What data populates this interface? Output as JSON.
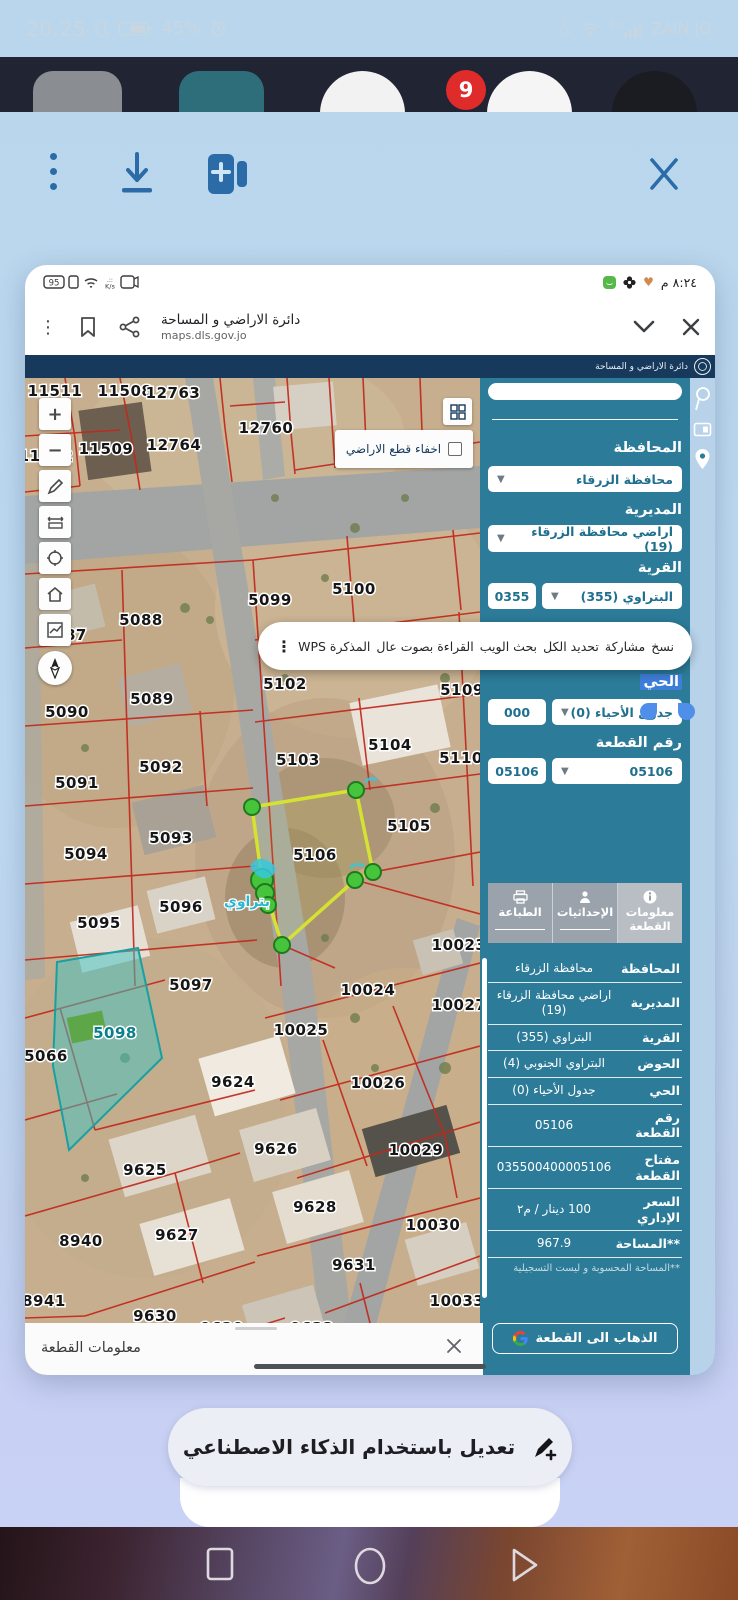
{
  "status_bar": {
    "time": "20:25",
    "battery_pct": "45%",
    "net_speed_value": "0",
    "net_speed_unit": "K/s",
    "net_gen": "4G",
    "carrier": "ZAIN JO"
  },
  "notification_badge": "9",
  "colors": {
    "panel_teal": "#2b7b99",
    "navy_header": "#16395c",
    "parcel_line_red": "#c2281c",
    "highlight_yellow": "#d6e232",
    "selected_parcel_teal": "#3ec4c4",
    "toolbar_blue": "#2b6ca8",
    "selection_blue": "#3d7ed8"
  },
  "inner_screenshot": {
    "status_bar": {
      "battery_pct": "95",
      "speed_unit": "K/s",
      "time": "٨:٢٤ م"
    },
    "browser": {
      "title": "دائرة الاراضي و المساحة",
      "url": "maps.dls.gov.jo"
    },
    "site_header": {
      "title": "دائرة الاراضي و المساحة"
    },
    "map": {
      "hide_parcels_label": "اخفاء قطع الاراضي",
      "marker_label": "بتراوي",
      "highlighted_parcel_id": "5106",
      "selected_fill_parcel_id": "5098",
      "parcel_labels": [
        {
          "id": "11511",
          "x": 30,
          "y": 18
        },
        {
          "id": "11508",
          "x": 100,
          "y": 18
        },
        {
          "id": "12763",
          "x": 148,
          "y": 20
        },
        {
          "id": "12760",
          "x": 241,
          "y": 55
        },
        {
          "id": "11509",
          "x": 81,
          "y": 76
        },
        {
          "id": "12764",
          "x": 149,
          "y": 72
        },
        {
          "id": "11512",
          "x": 21,
          "y": 83
        },
        {
          "id": "5088",
          "x": 116,
          "y": 247
        },
        {
          "id": "5087",
          "x": 40,
          "y": 262
        },
        {
          "id": "5099",
          "x": 245,
          "y": 227
        },
        {
          "id": "5100",
          "x": 329,
          "y": 216
        },
        {
          "id": "5107",
          "x": 436,
          "y": 257
        },
        {
          "id": "5102",
          "x": 260,
          "y": 311
        },
        {
          "id": "5109",
          "x": 437,
          "y": 317
        },
        {
          "id": "5090",
          "x": 42,
          "y": 339
        },
        {
          "id": "5089",
          "x": 127,
          "y": 326
        },
        {
          "id": "5092",
          "x": 136,
          "y": 394
        },
        {
          "id": "5104",
          "x": 365,
          "y": 372
        },
        {
          "id": "5103",
          "x": 273,
          "y": 387
        },
        {
          "id": "5110",
          "x": 436,
          "y": 385
        },
        {
          "id": "5091",
          "x": 52,
          "y": 410
        },
        {
          "id": "5105",
          "x": 384,
          "y": 453
        },
        {
          "id": "5094",
          "x": 61,
          "y": 481
        },
        {
          "id": "5093",
          "x": 146,
          "y": 465
        },
        {
          "id": "5106",
          "x": 290,
          "y": 482
        },
        {
          "id": "5096",
          "x": 156,
          "y": 534
        },
        {
          "id": "5095",
          "x": 74,
          "y": 550
        },
        {
          "id": "10023",
          "x": 434,
          "y": 572
        },
        {
          "id": "5097",
          "x": 166,
          "y": 612
        },
        {
          "id": "10024",
          "x": 343,
          "y": 617
        },
        {
          "id": "10027",
          "x": 434,
          "y": 632
        },
        {
          "id": "5098",
          "x": 90,
          "y": 660,
          "teal": true
        },
        {
          "id": "10025",
          "x": 276,
          "y": 657
        },
        {
          "id": "5066",
          "x": 21,
          "y": 683
        },
        {
          "id": "9624",
          "x": 208,
          "y": 709
        },
        {
          "id": "10026",
          "x": 353,
          "y": 710
        },
        {
          "id": "9626",
          "x": 251,
          "y": 776
        },
        {
          "id": "10029",
          "x": 391,
          "y": 777
        },
        {
          "id": "9625",
          "x": 120,
          "y": 797
        },
        {
          "id": "9628",
          "x": 290,
          "y": 834
        },
        {
          "id": "8940",
          "x": 56,
          "y": 868
        },
        {
          "id": "9627",
          "x": 152,
          "y": 862
        },
        {
          "id": "10030",
          "x": 408,
          "y": 852
        },
        {
          "id": "9631",
          "x": 329,
          "y": 892
        },
        {
          "id": "8941",
          "x": 19,
          "y": 928
        },
        {
          "id": "9630",
          "x": 130,
          "y": 943
        },
        {
          "id": "10033",
          "x": 432,
          "y": 928
        },
        {
          "id": "9629",
          "x": 197,
          "y": 955
        },
        {
          "id": "9632",
          "x": 287,
          "y": 955
        }
      ]
    },
    "selection_menu": {
      "items": [
        {
          "label": "نسخ"
        },
        {
          "label": "مشاركة"
        },
        {
          "label": "تحديد الكل"
        },
        {
          "label": "بحث الويب"
        },
        {
          "label": "القراءة بصوت عال"
        },
        {
          "label": "المذكرة WPS"
        }
      ]
    },
    "form": {
      "fields": [
        {
          "label": "المحافظة",
          "value": "محافظة الزرقاء"
        },
        {
          "label": "المديرية",
          "value": "اراضي محافظة الزرقاء (19)"
        },
        {
          "label": "القرية",
          "value": "البتراوي (355)",
          "code": "0355"
        },
        {
          "label": "الحي",
          "value": "جدول الأحياء (0)",
          "code": "000"
        },
        {
          "label": "رقم القطعة",
          "value": "05106",
          "code": "05106"
        }
      ]
    },
    "tabs": [
      {
        "label": "معلومات القطعة",
        "icon": "info-icon",
        "active": true
      },
      {
        "label": "الإحداثيات",
        "icon": "coordinates-icon",
        "active": false
      },
      {
        "label": "الطباعة",
        "icon": "printer-icon",
        "active": false
      }
    ],
    "info_panel": {
      "rows": [
        {
          "label": "المحافظة",
          "value": "محافظة الزرقاء"
        },
        {
          "label": "المديرية",
          "value": "اراضي محافظة الزرقاء (19)"
        },
        {
          "label": "القرية",
          "value": "البتراوي (355)"
        },
        {
          "label": "الحوض",
          "value": "البتراوي الجنوبي (4)"
        },
        {
          "label": "الحي",
          "value": "جدول الأحياء (0)"
        },
        {
          "label": "رقم القطعة",
          "value": "05106"
        },
        {
          "label": "مفتاح القطعة",
          "value": "035500400005106"
        },
        {
          "label": "السعر الإداري",
          "value": "100 دينار / م٢"
        },
        {
          "label": "**المساحة",
          "value": "967.9"
        }
      ],
      "area_note": "**المساحة المحسوبة و ليست التسجيلية",
      "goto_button": "الذهاب الى القطعة"
    },
    "bottom_sheet": {
      "title": "معلومات القطعة"
    }
  },
  "ai_suggestion": {
    "label": "تعديل باستخدام الذكاء الاصطناعي"
  }
}
